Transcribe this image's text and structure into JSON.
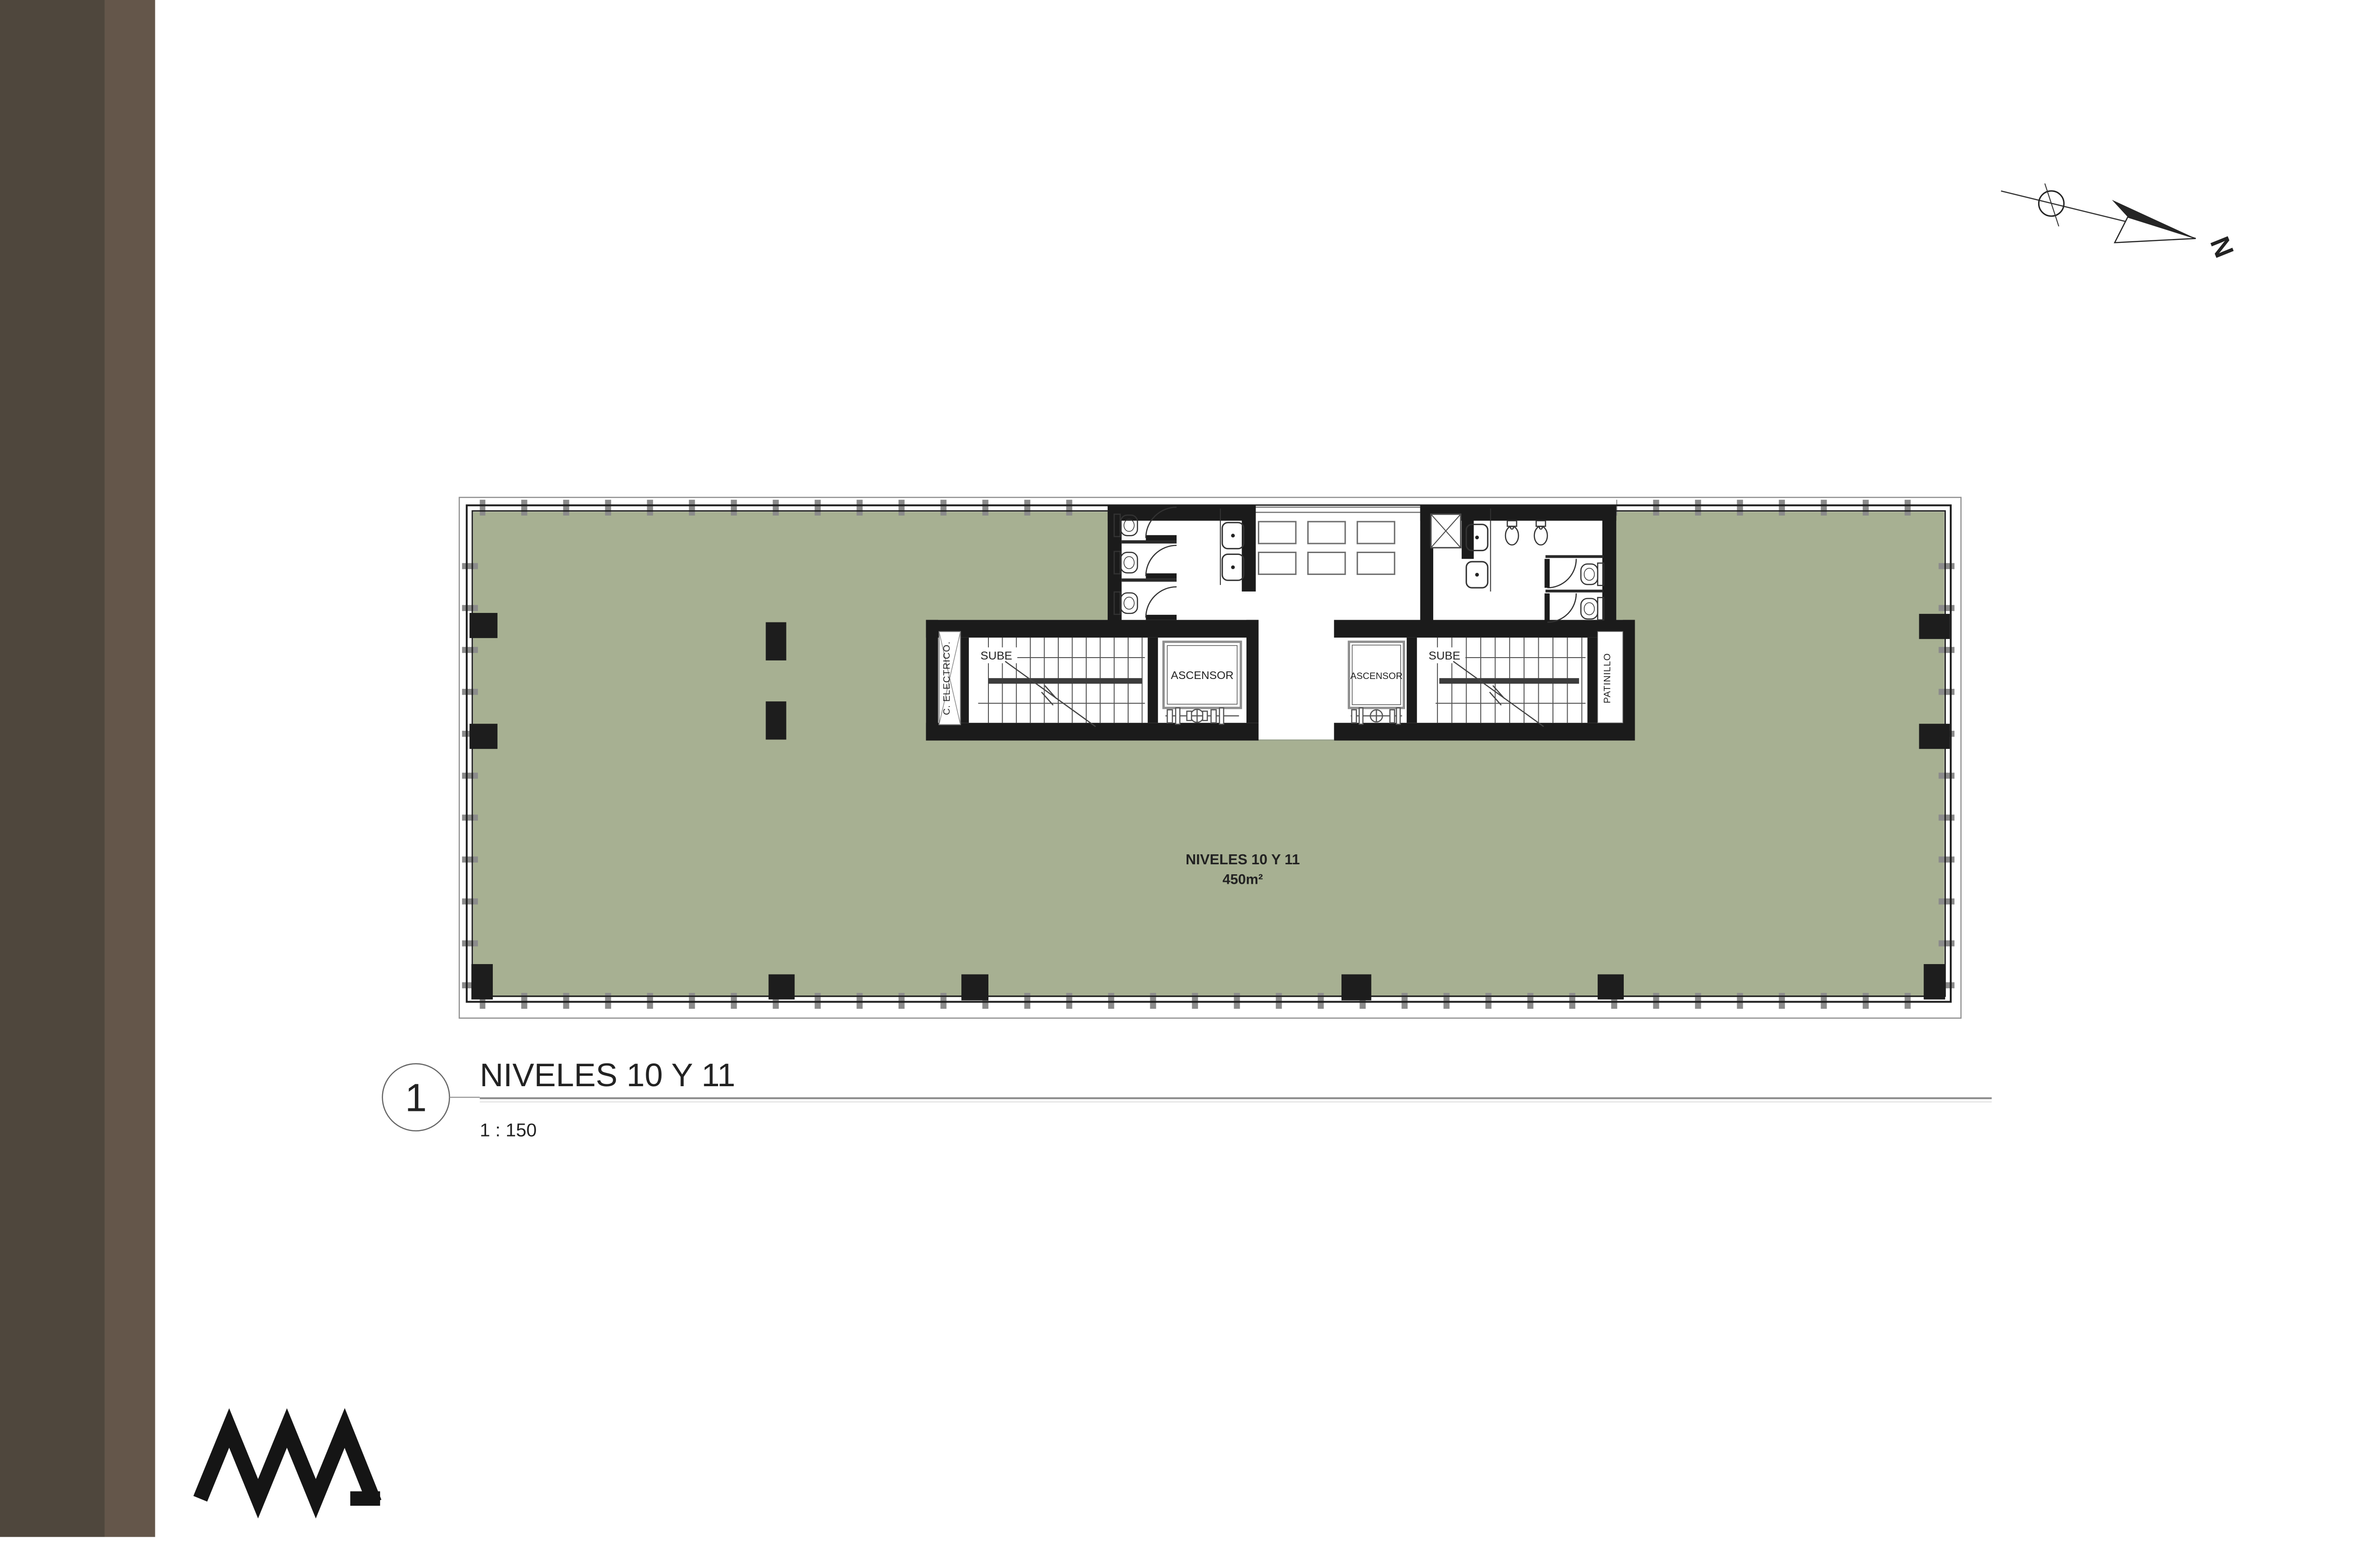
{
  "sidebar": {
    "dark_color": "#4f473d",
    "light_color": "#64564a"
  },
  "floor_plan": {
    "floor_color": "#a7b092",
    "wall_color": "#1b1b1b",
    "area_label": {
      "line1": "NIVELES 10 Y 11",
      "line2": "450m²"
    },
    "rooms": {
      "stair_left_label": "SUBE",
      "stair_right_label": "SUBE",
      "elevator_left_label": "ASCENSOR",
      "elevator_right_label": "ASCENSOR",
      "electrical_shaft_label": "C. ELECTRICO.",
      "patio_shaft_label": "PATINILLO"
    }
  },
  "north_arrow": {
    "label": "N"
  },
  "title_block": {
    "detail_number": "1",
    "title": "NIVELES 10 Y 11",
    "scale": "1 : 150"
  }
}
